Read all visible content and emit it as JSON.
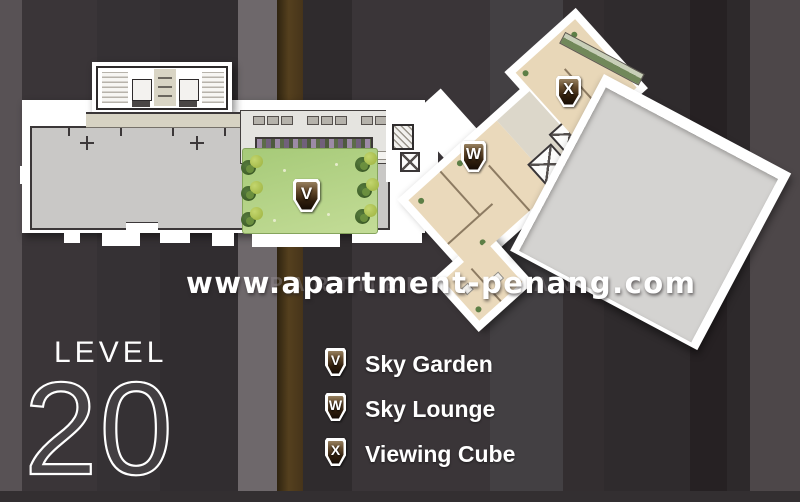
{
  "watermark": {
    "main": "www.apartment-penang.com",
    "ghost": "APARTMENT-PENANG"
  },
  "level_panel": {
    "label": "LEVEL",
    "number": "20"
  },
  "legend": {
    "items": [
      {
        "symbol": "V",
        "label": "Sky Garden"
      },
      {
        "symbol": "W",
        "label": "Sky Lounge"
      },
      {
        "symbol": "X",
        "label": "Viewing Cube"
      }
    ]
  },
  "floor_plan": {
    "markers": [
      {
        "symbol": "V",
        "area": "Sky Garden"
      },
      {
        "symbol": "W",
        "area": "Sky Lounge"
      },
      {
        "symbol": "X",
        "area": "Viewing Cube"
      }
    ]
  },
  "colors": {
    "background": "#332f31",
    "stripe_light": "#6e686b",
    "stripe_brown": "#4e3a1c",
    "plan_white": "#ffffff",
    "floor_grey": "#c9c8c6",
    "room_beige": "#ead9bb",
    "garden_green": "#a6ca78",
    "terrace_grey": "#d4d3d1",
    "badge_dark": "#241708"
  }
}
